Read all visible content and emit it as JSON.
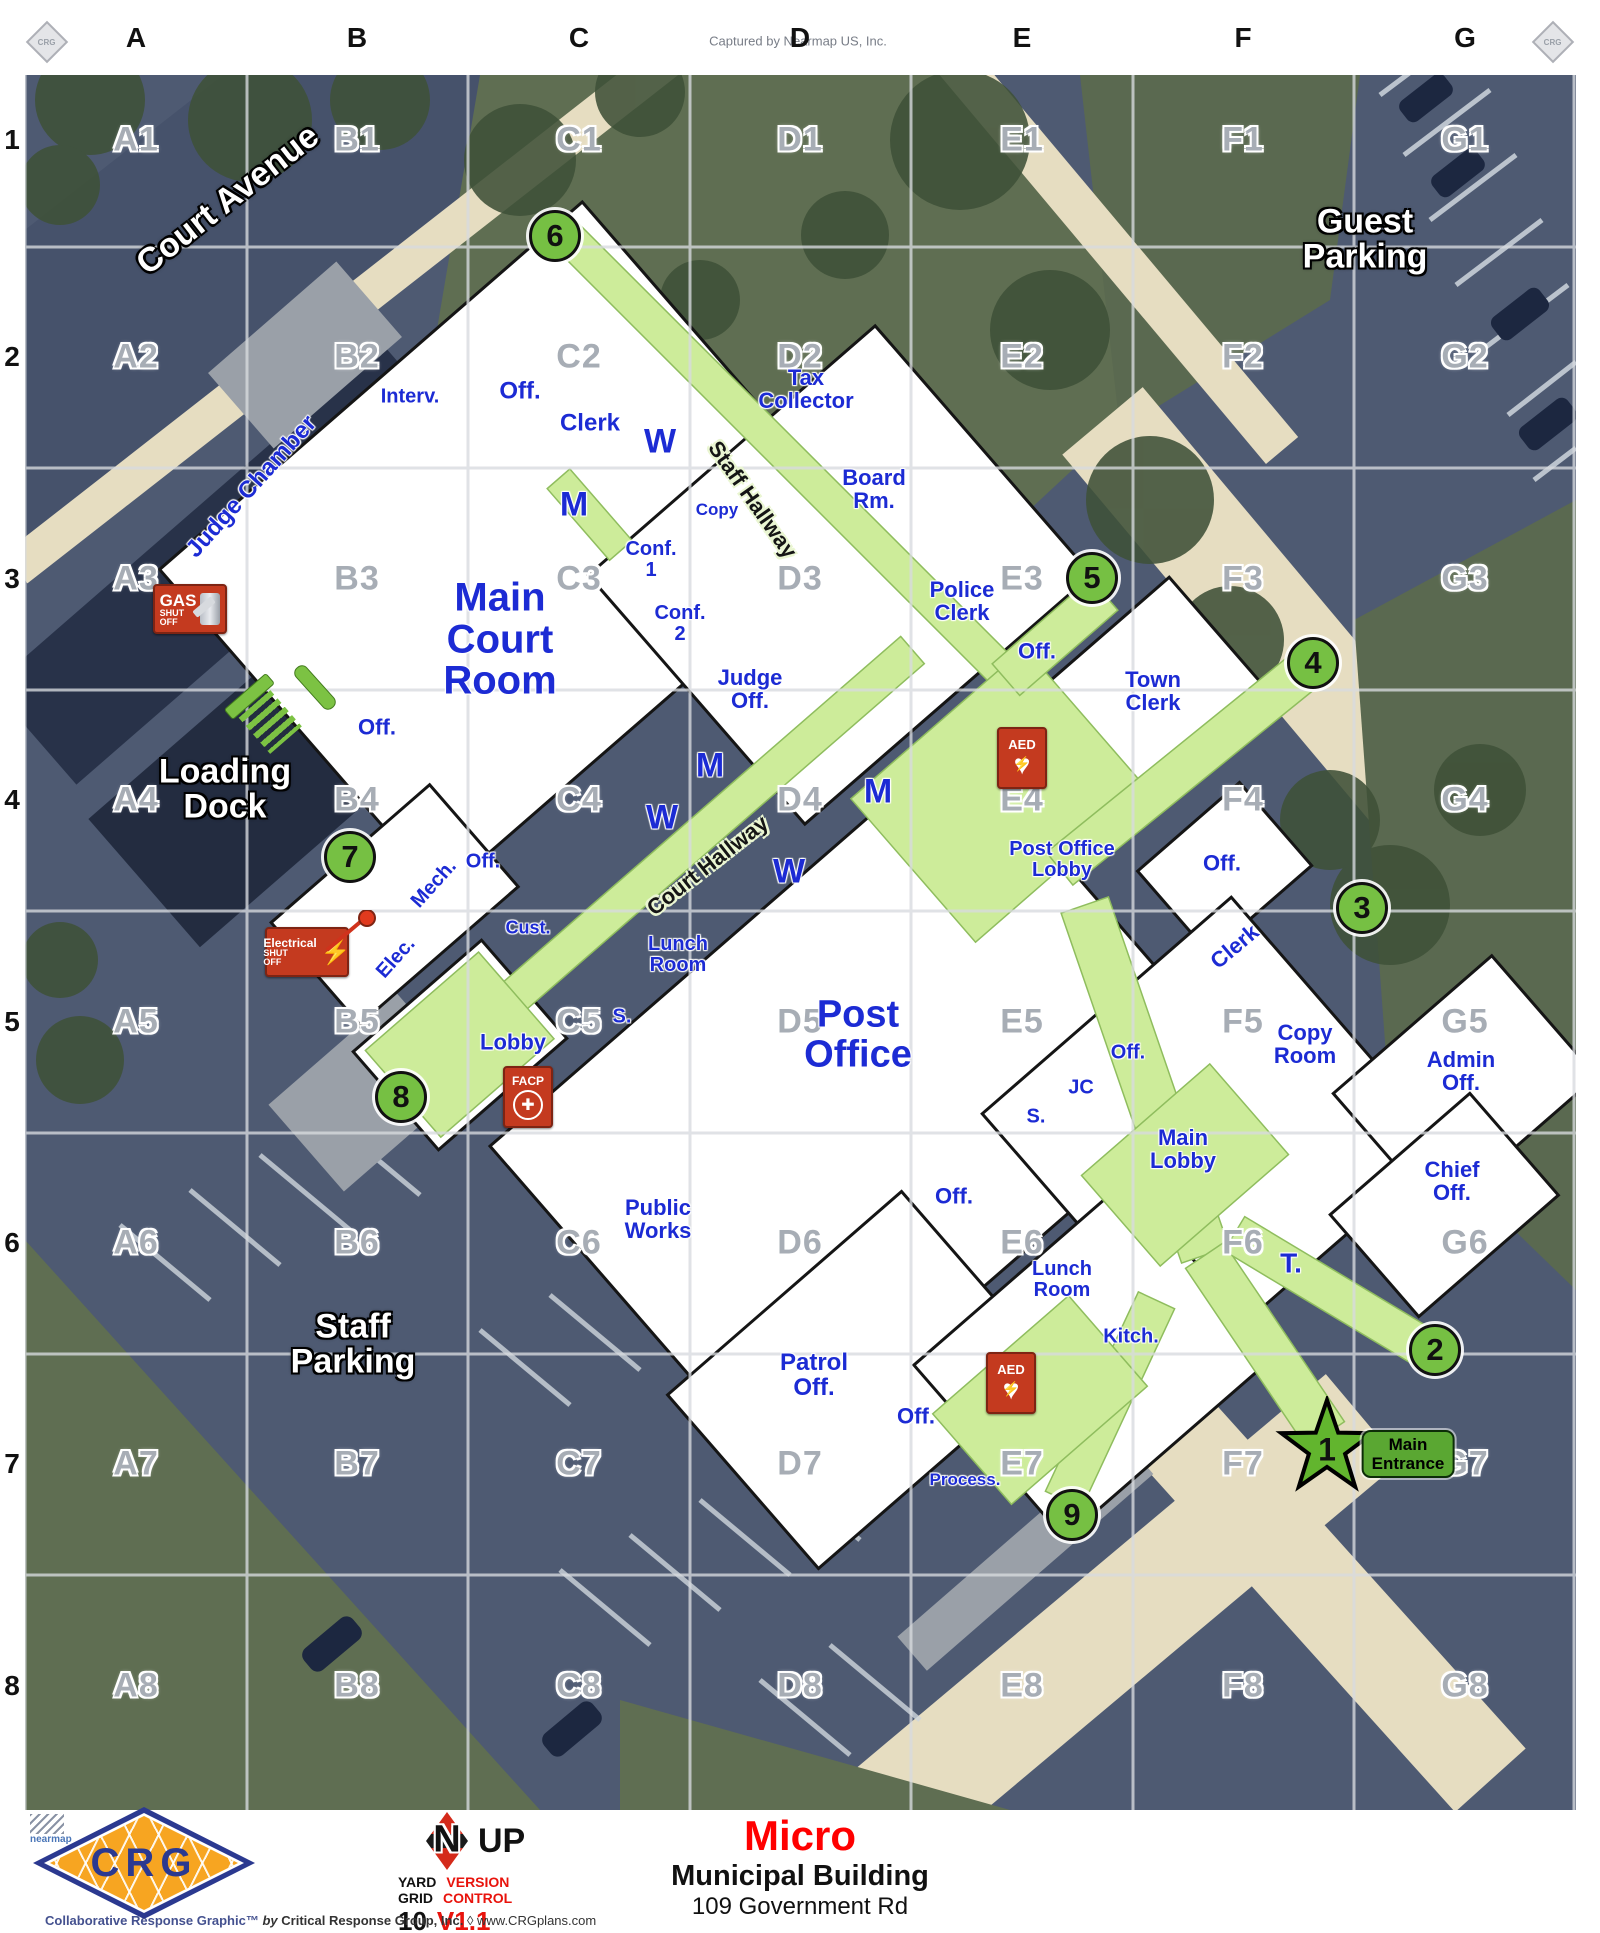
{
  "attribution": "Captured by Nearmap US, Inc.",
  "grid": {
    "columns": [
      "A",
      "B",
      "C",
      "D",
      "E",
      "F",
      "G"
    ],
    "rows": [
      "1",
      "2",
      "3",
      "4",
      "5",
      "6",
      "7",
      "8"
    ]
  },
  "area_labels": [
    {
      "label": "Court Avenue",
      "x": 228,
      "y": 200,
      "rot": -38,
      "size": 34
    },
    {
      "label": "Guest\nParking",
      "x": 1365,
      "y": 240,
      "rot": 0,
      "size": 34
    },
    {
      "label": "Loading\nDock",
      "x": 225,
      "y": 790,
      "rot": 0,
      "size": 34
    },
    {
      "label": "Staff\nParking",
      "x": 353,
      "y": 1345,
      "rot": 0,
      "size": 34
    }
  ],
  "hallway_labels": [
    {
      "label": "Staff Hallway",
      "x": 752,
      "y": 500,
      "rot": 55,
      "size": 22
    },
    {
      "label": "Court Hallway",
      "x": 708,
      "y": 866,
      "rot": -38,
      "size": 22
    }
  ],
  "rooms": [
    {
      "label": "Judge Chamber",
      "x": 252,
      "y": 487,
      "size": 24,
      "rot": -48
    },
    {
      "label": "Interv.",
      "x": 410,
      "y": 397,
      "size": 20,
      "rot": 0
    },
    {
      "label": "Off.",
      "x": 520,
      "y": 392,
      "size": 24,
      "rot": 0
    },
    {
      "label": "Clerk",
      "x": 590,
      "y": 424,
      "size": 24,
      "rot": 0
    },
    {
      "label": "W",
      "x": 660,
      "y": 442,
      "size": 34,
      "rot": 0
    },
    {
      "label": "M",
      "x": 574,
      "y": 505,
      "size": 34,
      "rot": 0
    },
    {
      "label": "Copy",
      "x": 717,
      "y": 510,
      "size": 17,
      "rot": 0
    },
    {
      "label": "Tax\nCollector",
      "x": 806,
      "y": 390,
      "size": 22,
      "rot": 0
    },
    {
      "label": "Board\nRm.",
      "x": 874,
      "y": 490,
      "size": 22,
      "rot": 0
    },
    {
      "label": "Main\nCourt\nRoom",
      "x": 500,
      "y": 640,
      "size": 40,
      "rot": 0
    },
    {
      "label": "Conf.\n1",
      "x": 651,
      "y": 560,
      "size": 20,
      "rot": 0
    },
    {
      "label": "Conf.\n2",
      "x": 680,
      "y": 624,
      "size": 20,
      "rot": 0
    },
    {
      "label": "Judge\nOff.",
      "x": 750,
      "y": 690,
      "size": 22,
      "rot": 0
    },
    {
      "label": "Police\nClerk",
      "x": 962,
      "y": 602,
      "size": 22,
      "rot": 0
    },
    {
      "label": "Off.",
      "x": 1037,
      "y": 652,
      "size": 22,
      "rot": 0
    },
    {
      "label": "Town\nClerk",
      "x": 1153,
      "y": 692,
      "size": 22,
      "rot": 0
    },
    {
      "label": "Off.",
      "x": 377,
      "y": 728,
      "size": 22,
      "rot": 0
    },
    {
      "label": "M",
      "x": 710,
      "y": 766,
      "size": 34,
      "rot": 0
    },
    {
      "label": "W",
      "x": 662,
      "y": 818,
      "size": 34,
      "rot": 0
    },
    {
      "label": "M",
      "x": 878,
      "y": 792,
      "size": 34,
      "rot": 0
    },
    {
      "label": "W",
      "x": 789,
      "y": 872,
      "size": 34,
      "rot": 0
    },
    {
      "label": "Post Office\nLobby",
      "x": 1062,
      "y": 860,
      "size": 20,
      "rot": 0
    },
    {
      "label": "Off.",
      "x": 1222,
      "y": 864,
      "size": 22,
      "rot": 0
    },
    {
      "label": "Off.",
      "x": 483,
      "y": 862,
      "size": 20,
      "rot": 0
    },
    {
      "label": "Mech.",
      "x": 434,
      "y": 884,
      "size": 20,
      "rot": -48
    },
    {
      "label": "Elec.",
      "x": 396,
      "y": 958,
      "size": 20,
      "rot": -48
    },
    {
      "label": "Cust.",
      "x": 528,
      "y": 928,
      "size": 18,
      "rot": 0
    },
    {
      "label": "Lunch\nRoom",
      "x": 678,
      "y": 955,
      "size": 20,
      "rot": 0
    },
    {
      "label": "S.",
      "x": 622,
      "y": 1017,
      "size": 20,
      "rot": 0
    },
    {
      "label": "Lobby",
      "x": 513,
      "y": 1043,
      "size": 22,
      "rot": 0
    },
    {
      "label": "Post\nOffice",
      "x": 858,
      "y": 1035,
      "size": 38,
      "rot": 0
    },
    {
      "label": "Public\nWorks",
      "x": 658,
      "y": 1220,
      "size": 22,
      "rot": 0
    },
    {
      "label": "Clerk",
      "x": 1235,
      "y": 947,
      "size": 22,
      "rot": -40
    },
    {
      "label": "Copy\nRoom",
      "x": 1305,
      "y": 1045,
      "size": 22,
      "rot": 0
    },
    {
      "label": "Admin\nOff.",
      "x": 1461,
      "y": 1072,
      "size": 22,
      "rot": 0
    },
    {
      "label": "Off.",
      "x": 1128,
      "y": 1053,
      "size": 20,
      "rot": 0
    },
    {
      "label": "JC",
      "x": 1081,
      "y": 1088,
      "size": 20,
      "rot": 0
    },
    {
      "label": "S.",
      "x": 1036,
      "y": 1117,
      "size": 20,
      "rot": 0
    },
    {
      "label": "Main\nLobby",
      "x": 1183,
      "y": 1150,
      "size": 22,
      "rot": 0
    },
    {
      "label": "Off.",
      "x": 954,
      "y": 1197,
      "size": 22,
      "rot": 0
    },
    {
      "label": "Chief\nOff.",
      "x": 1452,
      "y": 1182,
      "size": 22,
      "rot": 0
    },
    {
      "label": "Lunch\nRoom",
      "x": 1062,
      "y": 1280,
      "size": 20,
      "rot": 0
    },
    {
      "label": "Kitch.",
      "x": 1131,
      "y": 1337,
      "size": 20,
      "rot": 0
    },
    {
      "label": "T.",
      "x": 1291,
      "y": 1263,
      "size": 28,
      "rot": 0
    },
    {
      "label": "Patrol\nOff.",
      "x": 814,
      "y": 1376,
      "size": 24,
      "rot": 0
    },
    {
      "label": "Off.",
      "x": 916,
      "y": 1417,
      "size": 22,
      "rot": 0
    },
    {
      "label": "Process.",
      "x": 965,
      "y": 1480,
      "size": 17,
      "rot": 0
    }
  ],
  "markers": [
    {
      "num": "2",
      "x": 1435,
      "y": 1350
    },
    {
      "num": "3",
      "x": 1362,
      "y": 908
    },
    {
      "num": "4",
      "x": 1313,
      "y": 663
    },
    {
      "num": "5",
      "x": 1092,
      "y": 578
    },
    {
      "num": "6",
      "x": 555,
      "y": 236
    },
    {
      "num": "7",
      "x": 350,
      "y": 857
    },
    {
      "num": "8",
      "x": 401,
      "y": 1097
    },
    {
      "num": "9",
      "x": 1072,
      "y": 1515
    }
  ],
  "entrance": {
    "num": "1",
    "label": "Main\nEntrance",
    "star_x": 1327,
    "star_y": 1448,
    "pill_x": 1408,
    "pill_y": 1454
  },
  "safety": [
    {
      "type": "gas",
      "big": "GAS",
      "line1": "SHUT",
      "line2": "OFF",
      "x": 190,
      "y": 609
    },
    {
      "type": "electrical",
      "big": "Electrical",
      "line1": "SHUT",
      "line2": "OFF",
      "x": 307,
      "y": 952,
      "pin_x": 376,
      "pin_y": 918
    },
    {
      "type": "aed",
      "label": "AED",
      "x": 1022,
      "y": 758
    },
    {
      "type": "aed",
      "label": "AED",
      "x": 1011,
      "y": 1383
    },
    {
      "type": "facp",
      "label": "FACP",
      "x": 528,
      "y": 1097
    },
    {
      "type": "stairs",
      "x": 265,
      "y": 716
    }
  ],
  "colors": {
    "marker_green": "#76c043",
    "hallway_green": "#cdec9a",
    "room_blue": "#1c2bd4",
    "safety_red": "#c43a1f",
    "title_red": "#ff0000",
    "grid_grey": "#d8dbdf"
  },
  "corner_watermark": "CRG",
  "footer": {
    "nearmap": "nearmap",
    "logo_text": "CRG",
    "compass_n": "N",
    "compass_up": "UP",
    "yard": "YARD",
    "grid_word": "GRID",
    "grid_value": "10",
    "version": "VERSION",
    "control": "CONTROL",
    "version_value": "V1.1",
    "title": "Micro",
    "subtitle": "Municipal Building",
    "address": "109 Government Rd",
    "credit_brand": "Collaborative Response Graphic™",
    "credit_by": "by",
    "credit_company": "Critical Response Group, Inc.",
    "credit_sep": "◊",
    "credit_url": "www.CRGplans.com"
  }
}
